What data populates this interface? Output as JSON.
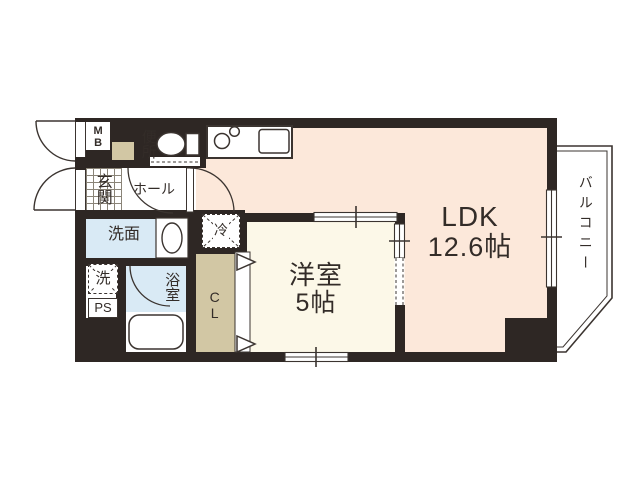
{
  "title": "apartment-floor-plan",
  "rooms": {
    "ldk": {
      "name": "LDK",
      "size": "12.6帖"
    },
    "bedroom": {
      "name": "洋室",
      "size": "5帖"
    },
    "balcony": {
      "name": "バルコニー"
    },
    "entrance": {
      "name": "玄関"
    },
    "hall": {
      "name": "ホール"
    },
    "washroom": {
      "name": "洗面"
    },
    "bathroom": {
      "name": "浴室"
    },
    "toilet": {
      "name": "便所"
    },
    "closet": {
      "name": "CL"
    },
    "meter_box": {
      "name": "MB"
    },
    "pipe_space": {
      "name": "PS"
    },
    "washer": {
      "name": "洗"
    },
    "refrigerator": {
      "name": "冷"
    }
  },
  "colors": {
    "wall": "#2e2724",
    "ldk_floor": "#fce8da",
    "bedroom_floor": "#fcf8e8",
    "wet_area_floor": "#d9eaf5",
    "closet_floor": "#d2c7a4",
    "line": "#3b3430",
    "text": "#332c28"
  }
}
